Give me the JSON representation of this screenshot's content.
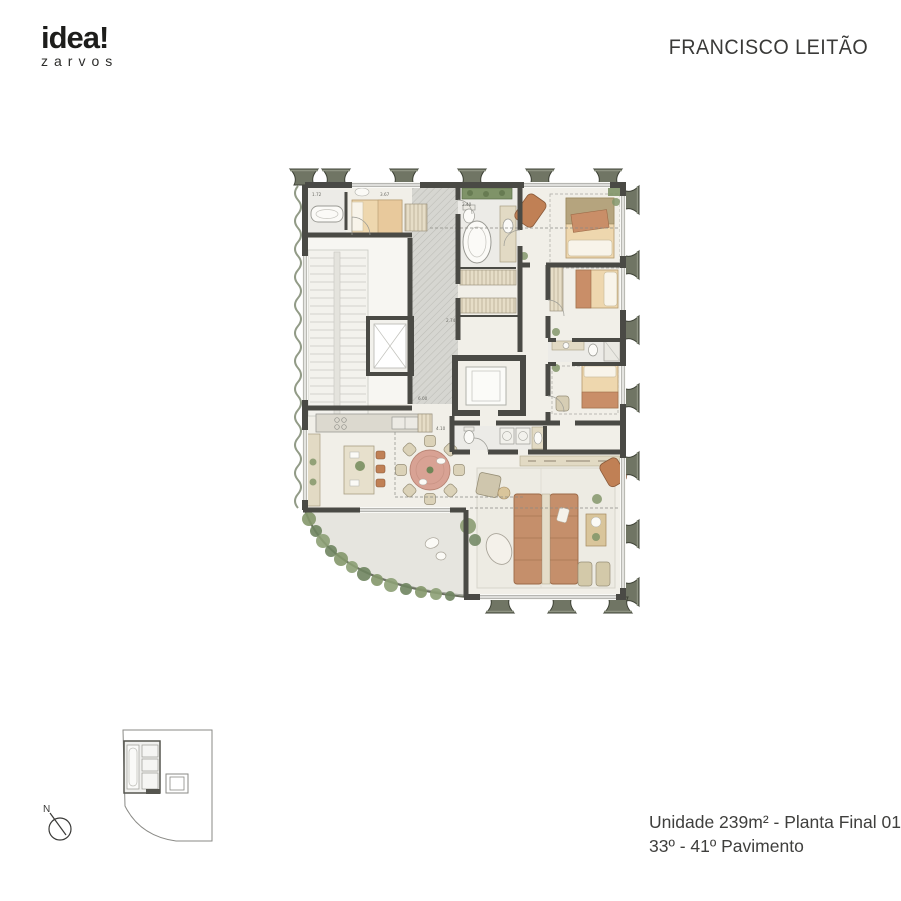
{
  "brand": {
    "logo_main": "idea!",
    "logo_sub": "zarvos"
  },
  "header": {
    "project_title": "FRANCISCO LEITÃO"
  },
  "plan": {
    "dimension_labels": [
      {
        "text": "1.72"
      },
      {
        "text": "3.67"
      },
      {
        "text": "2.40"
      },
      {
        "text": "2.74"
      },
      {
        "text": "6.00"
      },
      {
        "text": "4.10"
      }
    ]
  },
  "key_plan": {
    "north_label": "N"
  },
  "footer": {
    "line1": "Unidade 239m² - Planta Final 01",
    "line2": "33º - 41º Pavimento"
  },
  "colors": {
    "wall": "#4a4a45",
    "floor": "#f1efe8",
    "corridor_hatch": "#d4d4cf",
    "terrace": "#e6e5df",
    "wood_tan": "#ead2a9",
    "terracotta": "#c28a66",
    "blush": "#d8a294",
    "plant_green": "#84976b",
    "facade": "#707564",
    "text": "#3d3d3b"
  }
}
